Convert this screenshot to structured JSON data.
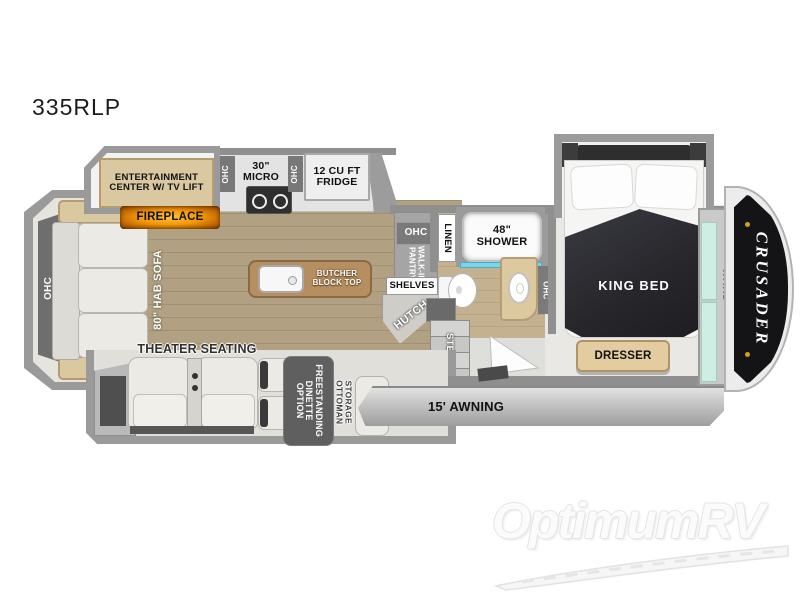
{
  "model": "335RLP",
  "brand": "CRUSADER",
  "watermark": "OptimumRV",
  "labels": {
    "ohc": "OHC",
    "sofa": "80\" HAB SOFA",
    "entertainment": "ENTERTAINMENT CENTER W/ TV LIFT",
    "fireplace": "FIREPLACE",
    "micro": "30\" MICRO",
    "fridge": "12 CU FT FRIDGE",
    "island": "BUTCHER BLOCK TOP",
    "theater": "THEATER SEATING",
    "dinette": "FREESTANDING DINETTE OPTION",
    "ottoman": "STORAGE OTTOMAN",
    "pantry": "WALK-IN PANTRY",
    "shelves": "SHELVES",
    "hutch": "HUTCH",
    "linen": "LINEN",
    "shower": "48\" SHOWER",
    "steps": "STEPS",
    "king_bed": "KING BED",
    "dresser": "DRESSER",
    "ward": "WARD",
    "awning": "15' AWNING"
  }
}
